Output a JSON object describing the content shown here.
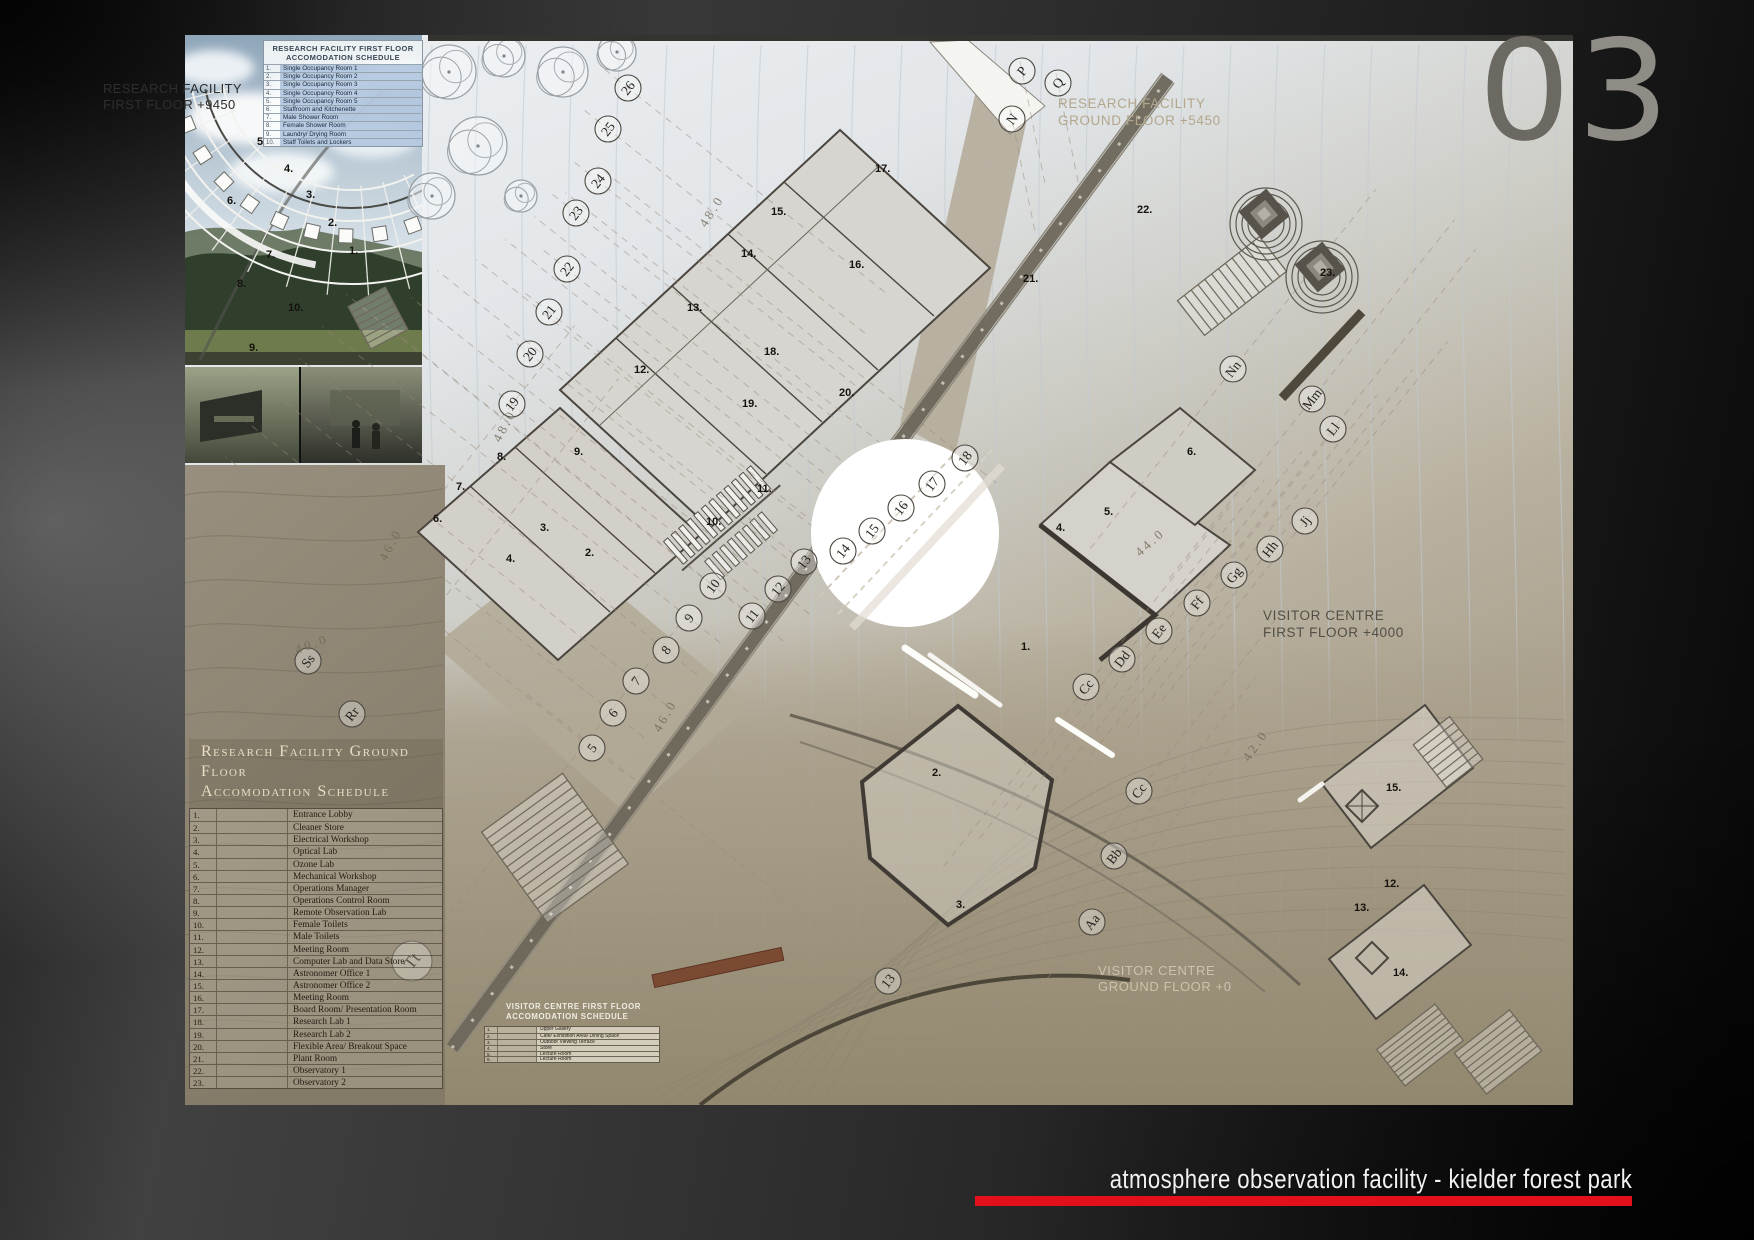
{
  "page": {
    "sheet_number_first": "0",
    "sheet_number_second": "3",
    "footer_title": "atmosphere observation facility  - kielder forest park"
  },
  "colors": {
    "accent_red": "#e30f1b",
    "sheet_number_dark": "#6c6862",
    "sheet_number_light": "#8f8b85"
  },
  "floor_labels": {
    "rf_first": [
      "RESEARCH FACILITY",
      "FIRST FLOOR +9450"
    ],
    "rf_ground": [
      "RESEARCH FACILITY",
      "GROUND FLOOR +5450"
    ],
    "vc_first": [
      "VISITOR CENTRE",
      "FIRST FLOOR +4000"
    ],
    "vc_ground": [
      "VISITOR CENTRE",
      "GROUND FLOOR +0"
    ]
  },
  "schedules": {
    "first_floor": {
      "title": [
        "RESEARCH FACILITY FIRST FLOOR",
        "ACCOMODATION SCHEDULE"
      ],
      "rows": [
        [
          "1.",
          "Single Occupancy Room 1"
        ],
        [
          "2.",
          "Single Occupancy Room 2"
        ],
        [
          "3.",
          "Single Occupancy Room 3"
        ],
        [
          "4.",
          "Single Occupancy Room 4"
        ],
        [
          "5.",
          "Single Occupancy Room 5"
        ],
        [
          "6.",
          "Staffroom and Kitchenette"
        ],
        [
          "7.",
          "Male Shower Room"
        ],
        [
          "8.",
          "Female Shower Room"
        ],
        [
          "9.",
          "Laundry/ Drying Room"
        ],
        [
          "10.",
          "Staff Toilets and Lockers"
        ]
      ]
    },
    "ground_floor": {
      "title": [
        "Research Facility Ground Floor",
        "Accomodation Schedule"
      ],
      "rows": [
        [
          "1.",
          "Entrance Lobby"
        ],
        [
          "2.",
          "Cleaner Store"
        ],
        [
          "3.",
          "Electrical Workshop"
        ],
        [
          "4.",
          "Optical Lab"
        ],
        [
          "5.",
          "Ozone Lab"
        ],
        [
          "6.",
          "Mechanical Workshop"
        ],
        [
          "7.",
          "Operations Manager"
        ],
        [
          "8.",
          "Operations Control Room"
        ],
        [
          "9.",
          "Remote Observation Lab"
        ],
        [
          "10.",
          "Female Toilets"
        ],
        [
          "11.",
          "Male Toilets"
        ],
        [
          "12.",
          "Meeting Room"
        ],
        [
          "13.",
          "Computer Lab and Data Store"
        ],
        [
          "14.",
          "Astronomer Office 1"
        ],
        [
          "15.",
          "Astronomer Office 2"
        ],
        [
          "16.",
          "Meeting Room"
        ],
        [
          "17.",
          "Board Room/ Presentation Room"
        ],
        [
          "18.",
          "Research Lab 1"
        ],
        [
          "19.",
          "Research Lab 2"
        ],
        [
          "20.",
          "Flexible Area/ Breakout Space"
        ],
        [
          "21.",
          "Plant Room"
        ],
        [
          "22.",
          "Observatory 1"
        ],
        [
          "23.",
          "Observatory 2"
        ]
      ]
    },
    "visitor_first": {
      "title": [
        "VISITOR CENTRE FIRST FLOOR",
        "ACCOMODATION SCHEDULE"
      ],
      "rows": [
        [
          "1.",
          "Upper Gallery"
        ],
        [
          "2.",
          "Cafe/ Exhibition Area/ Dining Space"
        ],
        [
          "3.",
          "Outdoor Viewing Terrace"
        ],
        [
          "4.",
          "Store"
        ],
        [
          "5.",
          "Lecture Room"
        ],
        [
          "6.",
          "Lecture Room"
        ]
      ]
    }
  },
  "grid_bubbles": {
    "road_numbers": [
      {
        "label": "5",
        "x": 592,
        "y": 748
      },
      {
        "label": "6",
        "x": 613,
        "y": 713
      },
      {
        "label": "7",
        "x": 636,
        "y": 681
      },
      {
        "label": "8",
        "x": 666,
        "y": 650
      },
      {
        "label": "9",
        "x": 689,
        "y": 618
      },
      {
        "label": "10",
        "x": 713,
        "y": 586
      },
      {
        "label": "11",
        "x": 752,
        "y": 616
      },
      {
        "label": "12",
        "x": 778,
        "y": 589
      },
      {
        "label": "13",
        "x": 804,
        "y": 562
      },
      {
        "label": "14",
        "x": 843,
        "y": 551
      },
      {
        "label": "15",
        "x": 872,
        "y": 531
      },
      {
        "label": "16",
        "x": 901,
        "y": 508
      },
      {
        "label": "17",
        "x": 932,
        "y": 484
      },
      {
        "label": "18",
        "x": 965,
        "y": 458
      },
      {
        "label": "13",
        "x": 888,
        "y": 981
      }
    ],
    "upper_numbers": [
      {
        "label": "19",
        "x": 512,
        "y": 404
      },
      {
        "label": "20",
        "x": 530,
        "y": 354
      },
      {
        "label": "21",
        "x": 549,
        "y": 312
      },
      {
        "label": "22",
        "x": 567,
        "y": 269
      },
      {
        "label": "23",
        "x": 576,
        "y": 213
      },
      {
        "label": "24",
        "x": 598,
        "y": 181
      },
      {
        "label": "25",
        "x": 608,
        "y": 129
      },
      {
        "label": "26",
        "x": 628,
        "y": 88
      }
    ],
    "top_letters": [
      {
        "label": "N",
        "x": 1012,
        "y": 119
      },
      {
        "label": "P",
        "x": 1022,
        "y": 71
      },
      {
        "label": "Q",
        "x": 1058,
        "y": 83
      }
    ],
    "right_letters": [
      {
        "label": "Nn",
        "x": 1233,
        "y": 369
      },
      {
        "label": "Mm",
        "x": 1312,
        "y": 399
      },
      {
        "label": "Ll",
        "x": 1333,
        "y": 429
      },
      {
        "label": "Jj",
        "x": 1305,
        "y": 521
      },
      {
        "label": "Hh",
        "x": 1270,
        "y": 549
      },
      {
        "label": "Gg",
        "x": 1234,
        "y": 575
      },
      {
        "label": "Ff",
        "x": 1197,
        "y": 603
      },
      {
        "label": "Ee",
        "x": 1159,
        "y": 631
      },
      {
        "label": "Dd",
        "x": 1122,
        "y": 659
      },
      {
        "label": "Cc",
        "x": 1086,
        "y": 687
      },
      {
        "label": "Cc",
        "x": 1139,
        "y": 791
      },
      {
        "label": "Bb",
        "x": 1114,
        "y": 856
      },
      {
        "label": "Aa",
        "x": 1092,
        "y": 922
      }
    ],
    "left_letters": [
      {
        "label": "Ss",
        "x": 308,
        "y": 661
      },
      {
        "label": "Rr",
        "x": 352,
        "y": 714
      },
      {
        "label": "Tt",
        "x": 412,
        "y": 961,
        "r": 20
      }
    ]
  },
  "room_numbers": {
    "main_plan": [
      {
        "label": "17.",
        "x": 875,
        "y": 172
      },
      {
        "label": "15.",
        "x": 771,
        "y": 215
      },
      {
        "label": "14.",
        "x": 741,
        "y": 257
      },
      {
        "label": "16.",
        "x": 849,
        "y": 268
      },
      {
        "label": "21.",
        "x": 1023,
        "y": 282
      },
      {
        "label": "13.",
        "x": 687,
        "y": 311
      },
      {
        "label": "18.",
        "x": 764,
        "y": 355
      },
      {
        "label": "12.",
        "x": 634,
        "y": 373
      },
      {
        "label": "19.",
        "x": 742,
        "y": 407
      },
      {
        "label": "20.",
        "x": 839,
        "y": 396
      },
      {
        "label": "8.",
        "x": 497,
        "y": 460
      },
      {
        "label": "9.",
        "x": 574,
        "y": 455
      },
      {
        "label": "7.",
        "x": 456,
        "y": 490
      },
      {
        "label": "11.",
        "x": 757,
        "y": 492
      },
      {
        "label": "6.",
        "x": 433,
        "y": 522
      },
      {
        "label": "3.",
        "x": 540,
        "y": 531
      },
      {
        "label": "10.",
        "x": 706,
        "y": 525
      },
      {
        "label": "2.",
        "x": 585,
        "y": 556
      },
      {
        "label": "4.",
        "x": 506,
        "y": 562
      },
      {
        "label": "22.",
        "x": 1137,
        "y": 213
      },
      {
        "label": "23.",
        "x": 1320,
        "y": 276
      },
      {
        "label": "6.",
        "x": 1187,
        "y": 455
      },
      {
        "label": "5.",
        "x": 1104,
        "y": 515
      },
      {
        "label": "4.",
        "x": 1056,
        "y": 531
      },
      {
        "label": "1.",
        "x": 1021,
        "y": 650
      },
      {
        "label": "2.",
        "x": 932,
        "y": 776
      },
      {
        "label": "3.",
        "x": 956,
        "y": 908
      },
      {
        "label": "15.",
        "x": 1386,
        "y": 791
      },
      {
        "label": "12.",
        "x": 1384,
        "y": 887
      },
      {
        "label": "13.",
        "x": 1354,
        "y": 911
      },
      {
        "label": "14.",
        "x": 1393,
        "y": 976
      }
    ],
    "photo_plan": [
      {
        "label": "5.",
        "x": 257,
        "y": 145
      },
      {
        "label": "4.",
        "x": 284,
        "y": 172
      },
      {
        "label": "3.",
        "x": 306,
        "y": 198
      },
      {
        "label": "2.",
        "x": 328,
        "y": 226
      },
      {
        "label": "1.",
        "x": 349,
        "y": 254
      },
      {
        "label": "6.",
        "x": 227,
        "y": 204
      },
      {
        "label": "7.",
        "x": 266,
        "y": 258
      },
      {
        "label": "8.",
        "x": 237,
        "y": 287
      },
      {
        "label": "10.",
        "x": 288,
        "y": 311
      },
      {
        "label": "9.",
        "x": 249,
        "y": 351
      }
    ]
  },
  "contour_labels": [
    {
      "label": "48.0",
      "x": 706,
      "y": 228,
      "rot": -58
    },
    {
      "label": "48.0",
      "x": 500,
      "y": 443,
      "rot": -62
    },
    {
      "label": "46.0",
      "x": 386,
      "y": 562,
      "rot": -62
    },
    {
      "label": "44.0",
      "x": 1140,
      "y": 557,
      "rot": -42
    },
    {
      "label": "42.0",
      "x": 1249,
      "y": 762,
      "rot": -55
    },
    {
      "label": "40.0",
      "x": 297,
      "y": 654,
      "rot": -20
    },
    {
      "label": "46.0",
      "x": 660,
      "y": 733,
      "rot": -60
    }
  ]
}
